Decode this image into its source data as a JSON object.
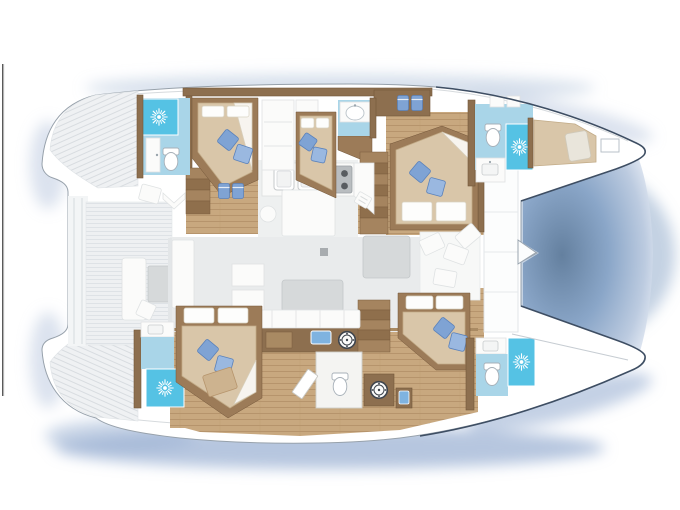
{
  "diagram": {
    "kind": "Catamaran yacht interior floor plan, top-down deck view",
    "orientation": "bows pointing right, twin sterns with steps at left"
  },
  "palette": {
    "hull_stroke": "#97a1ab",
    "bow_stroke": "#3e4e63",
    "glow_soft": "#b7c6dd",
    "glow_mid": "#9db3d4",
    "shadow_core": "#64809f",
    "wall_brown": "#8d6f4f",
    "wall_brown_dark": "#74573a",
    "wood": "#c8a87f",
    "wood_line": "#b6946c",
    "bed_frame": "#9c7b58",
    "mattress": "#d9c6a9",
    "mattress_edge": "#c2ab87",
    "linen": "#fdfdfc",
    "pillow_blue": "#7fa3d4",
    "pillow_blue_light": "#9ab8e0",
    "pillow_blue_dark": "#5b82bb",
    "bath_floor": "#a9d5e8",
    "shower_cyan": "#55c2e4",
    "deck": "#eef0f2",
    "deck_line": "#dbdfe3",
    "salon_floor": "#e9ebec",
    "furniture_gray": "#d6d9da",
    "counter_white": "#fafaf9",
    "stove_gray": "#b9bdc0",
    "burner_dark": "#585c60",
    "appliance_blue": "#7fb3e0"
  },
  "icons": [
    {
      "name": "shower-sunburst-icon",
      "count": 4
    },
    {
      "name": "toilet-icon",
      "count": 4
    },
    {
      "name": "sink-icon",
      "count": 6
    },
    {
      "name": "stove-burners-icon",
      "burners": 4
    },
    {
      "name": "washing-machine-icon",
      "count": 2
    },
    {
      "name": "blue-pillow-icon",
      "count": 10
    },
    {
      "name": "blue-towel-icon",
      "count": 4
    }
  ],
  "inventory": {
    "double_cabins": 5,
    "bow_berths": 1,
    "wet_heads": 5,
    "tables": 3,
    "stair_runs": 3
  },
  "rooms": [
    {
      "name": "aft-cockpit"
    },
    {
      "name": "salon"
    },
    {
      "name": "galley"
    },
    {
      "name": "head-top-aft"
    },
    {
      "name": "cabin-top-1"
    },
    {
      "name": "cabin-top-2"
    },
    {
      "name": "vanity-top-mid"
    },
    {
      "name": "cabin-right-upper"
    },
    {
      "name": "head-bow-upper"
    },
    {
      "name": "bow-berth"
    },
    {
      "name": "forward-lounge"
    },
    {
      "name": "head-bottom-aft"
    },
    {
      "name": "cabin-bottom-1"
    },
    {
      "name": "day-head"
    },
    {
      "name": "cabin-bottom-2"
    },
    {
      "name": "head-bow-lower"
    }
  ]
}
